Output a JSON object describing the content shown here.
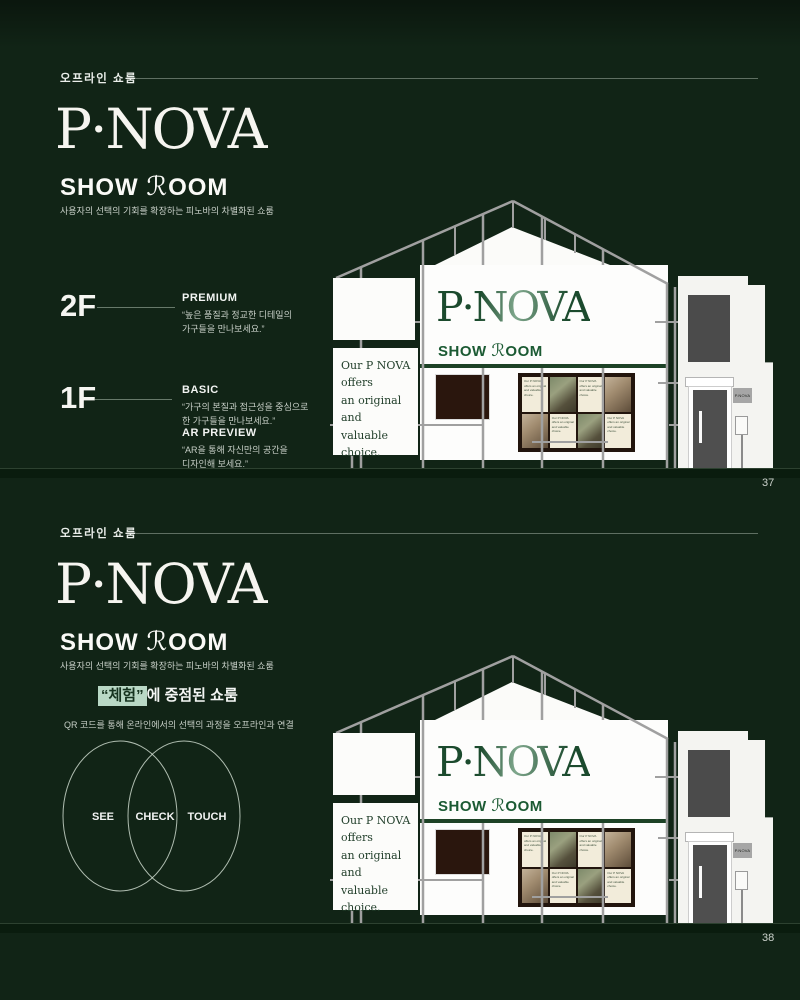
{
  "colors": {
    "background": "#112416",
    "ground": "#0a1c0e",
    "banner_green": "#1b5a33",
    "highlight_mint": "#b9d8c5",
    "logo_white": "#f6f5f0"
  },
  "slide1": {
    "eyebrow": "오프라인 쇼룸",
    "logo": "P·NOVA",
    "show": "SHOW",
    "script_r": "ℛ",
    "oom": "OOM",
    "tagline": "사용자의 선택의 기회를 확장하는 피노바의 차별화된 쇼룸",
    "floors": [
      {
        "level": "2F",
        "items": [
          {
            "title": "PREMIUM",
            "desc": "“높은 품질과 정교한 디테일의\n가구들을 만나보세요.”"
          }
        ]
      },
      {
        "level": "1F",
        "items": [
          {
            "title": "BASIC",
            "desc": "“가구의 본질과 접근성을 중심으로\n한 가구들을 만나보세요.”"
          },
          {
            "title": "AR PREVIEW",
            "desc": "“AR을 통해 자신만의 공간을\n디자인해 보세요.”"
          }
        ]
      }
    ],
    "page_number": "37"
  },
  "slide2": {
    "eyebrow": "오프라인 쇼룸",
    "logo": "P·NOVA",
    "show": "SHOW",
    "script_r": "ℛ",
    "oom": "OOM",
    "tagline": "사용자의 선택의 기회를 확장하는 피노바의 차별화된 쇼룸",
    "feature": {
      "highlight": "“체험”",
      "rest": "에 중점된 쇼룸",
      "sub": "QR 코드를 통해 온라인에서의 선택의 과정을 오프라인과 연결",
      "venn": [
        "SEE",
        "CHECK",
        "TOUCH"
      ]
    },
    "page_number": "38"
  },
  "building": {
    "banner_logo": "P·NOVA",
    "banner_show": "SHOW",
    "banner_script_r": "ℛ",
    "banner_oom": "OOM",
    "poster_text": "Our P NOVA\noffers\nan original and\nvaluable\nchoice.",
    "card_text": "Our P NOVA offers an original and valuable choice.",
    "plaque_text": "P.NOVA",
    "board_pattern": [
      "card",
      "photo-a",
      "card",
      "photo-b",
      "photo-b",
      "card",
      "photo-a",
      "card"
    ]
  }
}
